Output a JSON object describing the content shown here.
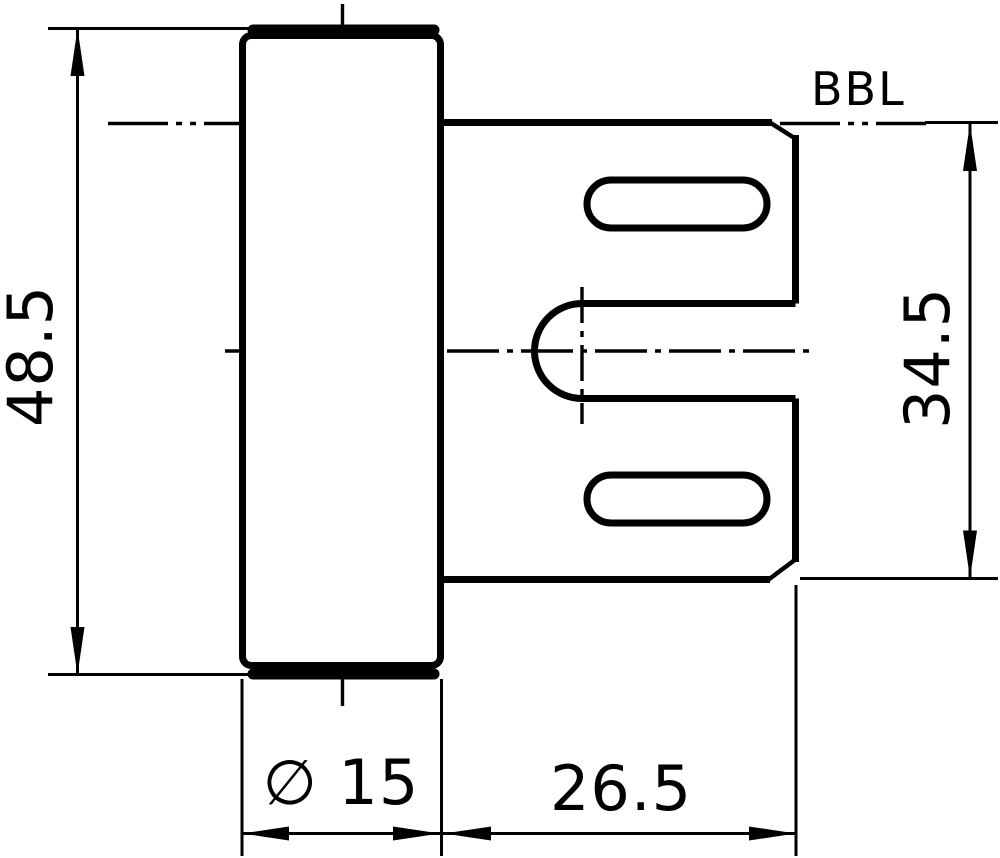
{
  "drawing": {
    "reference_label": "BBL",
    "dimensions": {
      "overall_height": "48.5",
      "plate_height": "34.5",
      "barrel_diameter": "∅ 15",
      "plate_width": "26.5"
    },
    "colors": {
      "ink": "#000000",
      "paper": "#ffffff"
    }
  }
}
